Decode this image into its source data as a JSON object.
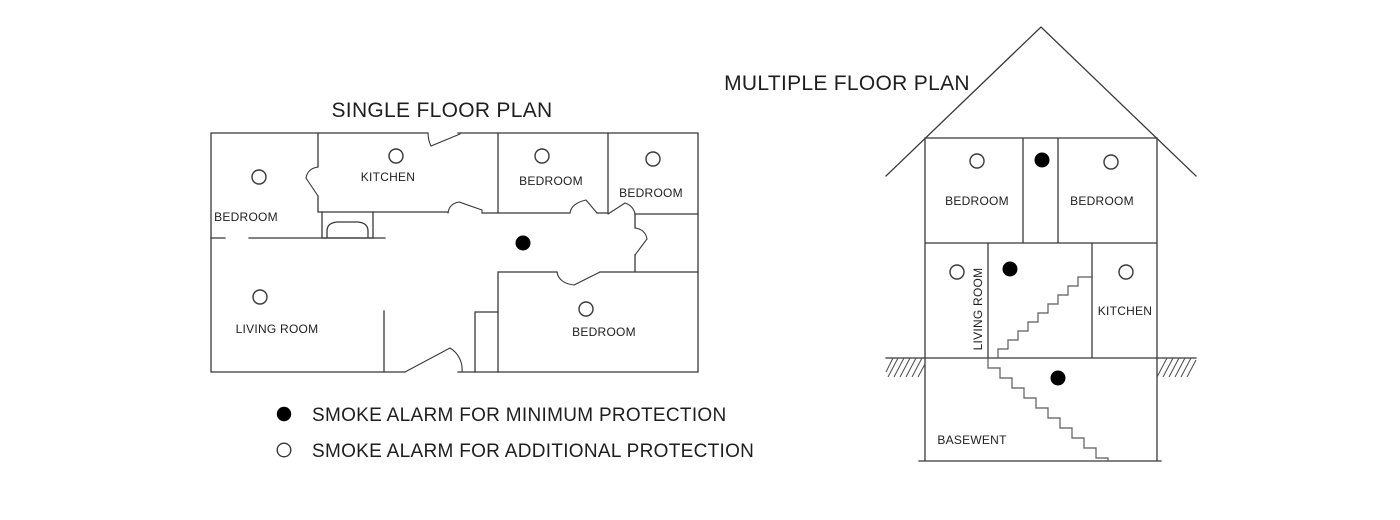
{
  "colors": {
    "background": "#ffffff",
    "line": "#383838",
    "text": "#1e1e1e",
    "alarm_minimum_fill": "#000000",
    "alarm_additional_fill": "#ffffff"
  },
  "single_floor_plan": {
    "title": "SINGLE FLOOR PLAN",
    "rooms": [
      {
        "name": "BEDROOM",
        "x": 246,
        "y": 221
      },
      {
        "name": "KITCHEN",
        "x": 388,
        "y": 181
      },
      {
        "name": "BEDROOM",
        "x": 551,
        "y": 185
      },
      {
        "name": "BEDROOM",
        "x": 651,
        "y": 197
      },
      {
        "name": "LIVING ROOM",
        "x": 277,
        "y": 333
      },
      {
        "name": "BEDROOM",
        "x": 604,
        "y": 336
      }
    ],
    "alarms": [
      {
        "type": "additional",
        "room": "bedroom-top-left",
        "x": 259,
        "y": 177
      },
      {
        "type": "additional",
        "room": "kitchen",
        "x": 396,
        "y": 156
      },
      {
        "type": "additional",
        "room": "bedroom-top-middle",
        "x": 542,
        "y": 156
      },
      {
        "type": "additional",
        "room": "bedroom-top-right",
        "x": 653,
        "y": 159
      },
      {
        "type": "minimum",
        "room": "hallway",
        "x": 523,
        "y": 243
      },
      {
        "type": "additional",
        "room": "living-room",
        "x": 260,
        "y": 297
      },
      {
        "type": "additional",
        "room": "bedroom-bottom",
        "x": 586,
        "y": 309
      }
    ]
  },
  "multiple_floor_plan": {
    "title": "MULTIPLE FLOOR PLAN",
    "rooms": [
      {
        "name": "BEDROOM",
        "x": 977,
        "y": 205
      },
      {
        "name": "BEDROOM",
        "x": 1102,
        "y": 205
      },
      {
        "name": "LIVING ROOM",
        "x": 982,
        "y": 309,
        "rotate": -90
      },
      {
        "name": "KITCHEN",
        "x": 1125,
        "y": 315
      },
      {
        "name": "BASEWENT",
        "x": 972,
        "y": 444
      }
    ],
    "alarms": [
      {
        "type": "additional",
        "room": "bedroom-left",
        "x": 977,
        "y": 161
      },
      {
        "type": "minimum",
        "room": "upper-hallway",
        "x": 1042,
        "y": 160
      },
      {
        "type": "additional",
        "room": "bedroom-right",
        "x": 1111,
        "y": 162
      },
      {
        "type": "additional",
        "room": "living-room",
        "x": 957,
        "y": 272
      },
      {
        "type": "minimum",
        "room": "stair-landing",
        "x": 1010,
        "y": 269
      },
      {
        "type": "additional",
        "room": "kitchen",
        "x": 1126,
        "y": 272
      },
      {
        "type": "minimum",
        "room": "basement",
        "x": 1058,
        "y": 378
      }
    ]
  },
  "legend": {
    "items": [
      {
        "symbol": "filled-circle",
        "label": "SMOKE ALARM FOR MINIMUM PROTECTION"
      },
      {
        "symbol": "open-circle",
        "label": "SMOKE ALARM FOR ADDITIONAL PROTECTION"
      }
    ]
  }
}
